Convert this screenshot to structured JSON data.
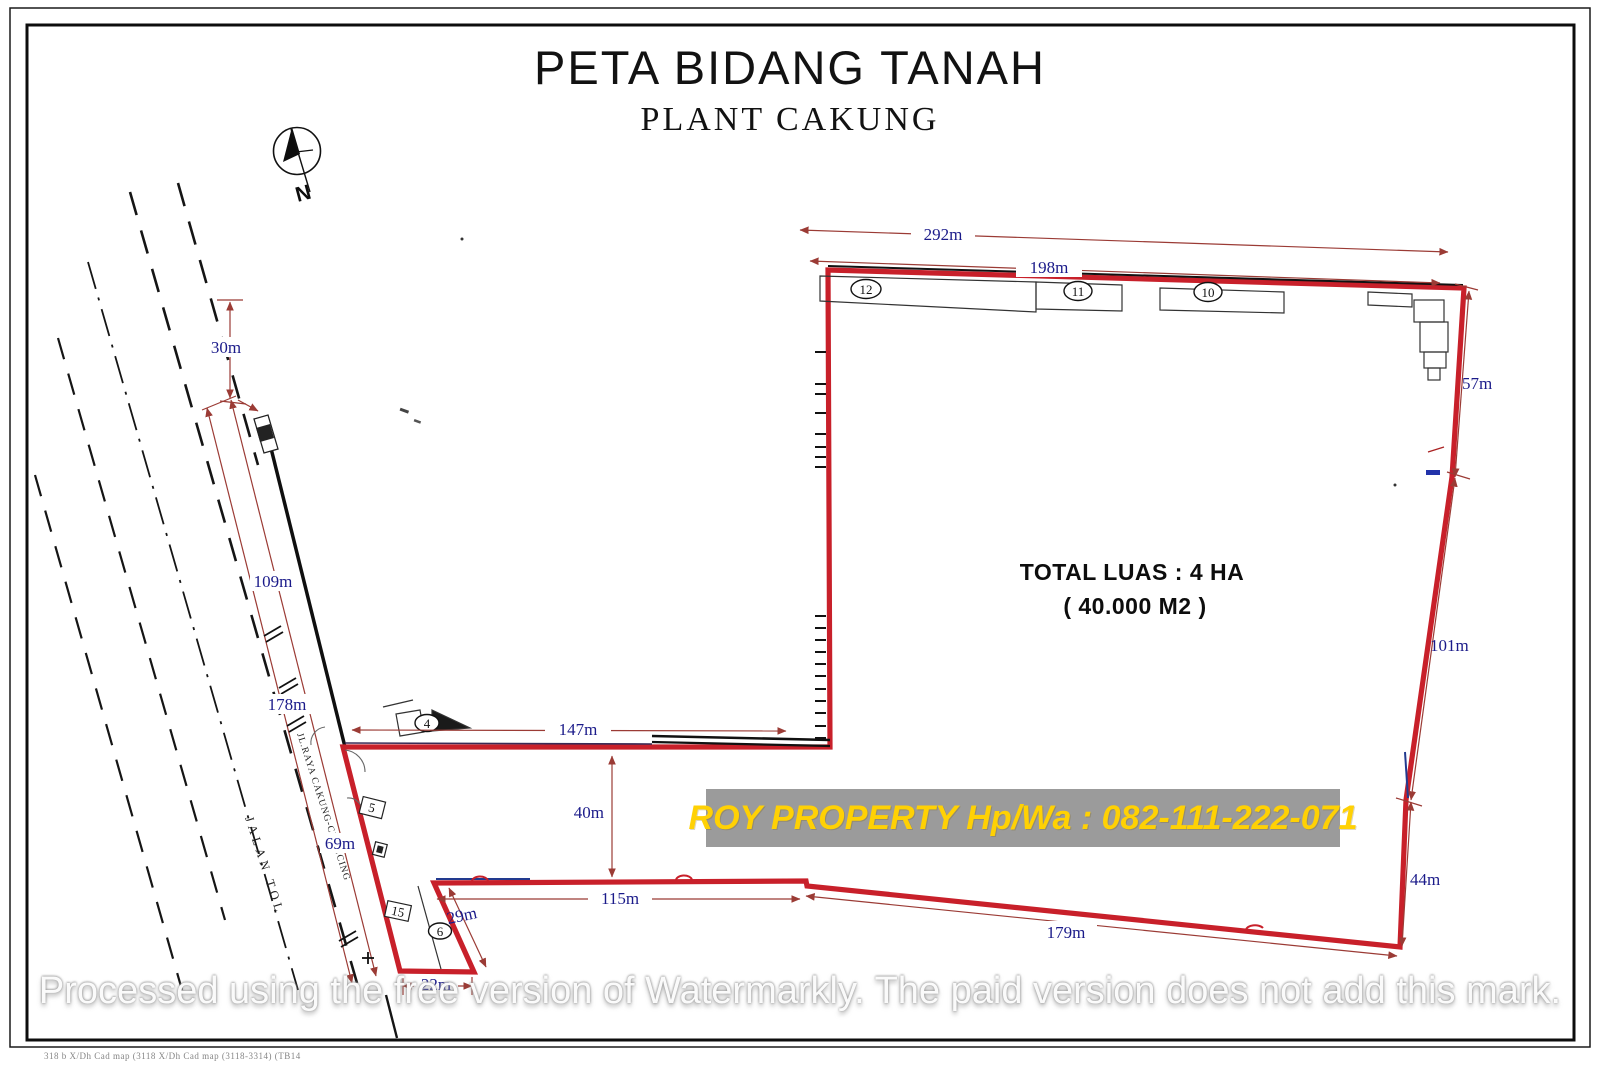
{
  "title": "PETA BIDANG TANAH",
  "subtitle": "PLANT CAKUNG",
  "compass_label": "N",
  "total_area": {
    "line1": "TOTAL LUAS : 4 HA",
    "line2": "( 40.000 M2 )"
  },
  "banner_text": "ROY PROPERTY Hp/Wa : 082-111-222-071",
  "watermark_text": "Processed using the free version of Watermarkly. The paid version does not add this mark.",
  "footer_text": "318 b X/Dh    Cad map (3118 X/Dh    Cad map (3118-3314) (TB14",
  "roads": {
    "toll_label": "JALAN TOL",
    "main_label": "JL.RAYA CAKUNG-CILINCING"
  },
  "dimensions": {
    "top_outer": "292m",
    "top_inner": "198m",
    "right_upper": "57m",
    "right_middle": "101m",
    "right_lower": "44m",
    "bottom_long": "179m",
    "bottom_inner": "115m",
    "leg_bottom": "22m",
    "leg_diagonal": "29m",
    "notch_gap": "40m",
    "middle_edge": "147m",
    "road_width": "30m",
    "road_upper": "109m",
    "road_total": "178m",
    "road_lower": "69m"
  },
  "plot_numbers": {
    "n12": "12",
    "n11": "11",
    "n10": "10",
    "n4": "4",
    "n5": "5",
    "n15": "15",
    "n6": "6"
  },
  "colors": {
    "boundary_red": "#c8202a",
    "dimension_line": "#9b3b35",
    "dimension_label": "#1b1b8a",
    "banner_bg": "#9b9b9b",
    "banner_text": "#ffd104"
  }
}
